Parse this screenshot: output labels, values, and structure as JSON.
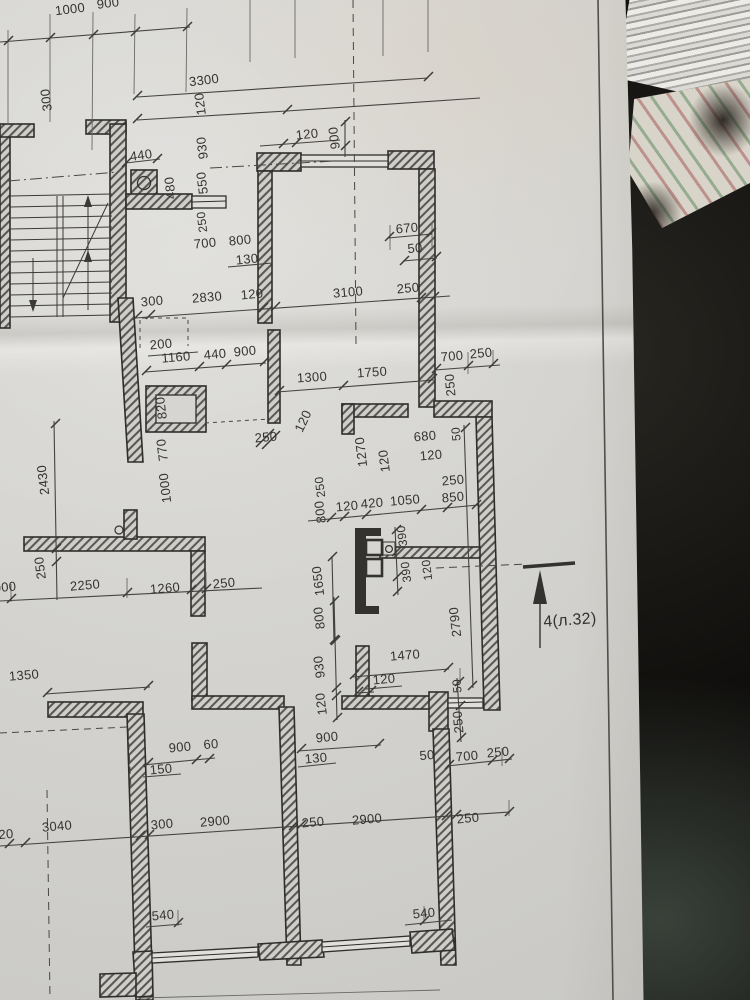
{
  "scene": {
    "description": "photo of an architectural floor plan on a dark table",
    "paper_color": "#d4d3cf",
    "table_color": "#171613",
    "line_color": "#35332f",
    "section_marker": "4(л.32)"
  },
  "plan": {
    "labels": [
      {
        "t": "1000",
        "x": 70,
        "y": 9,
        "r": -7
      },
      {
        "t": "900",
        "x": 108,
        "y": 3,
        "r": -7
      },
      {
        "t": "300",
        "x": 46,
        "y": 100,
        "r": -97
      },
      {
        "t": "3300",
        "x": 204,
        "y": 80,
        "r": -7
      },
      {
        "t": "120",
        "x": 200,
        "y": 104,
        "r": -97
      },
      {
        "t": "120",
        "x": 307,
        "y": 134,
        "r": -6
      },
      {
        "t": "900",
        "x": 334,
        "y": 138,
        "r": -97
      },
      {
        "t": "440",
        "x": 141,
        "y": 155,
        "r": -8
      },
      {
        "t": "930",
        "x": 202,
        "y": 148,
        "r": -97
      },
      {
        "t": "480",
        "x": 170,
        "y": 188,
        "r": -97
      },
      {
        "t": "550",
        "x": 202,
        "y": 183,
        "r": -97
      },
      {
        "t": "250",
        "x": 202,
        "y": 222,
        "r": -97,
        "s": 12
      },
      {
        "t": "700",
        "x": 205,
        "y": 243,
        "r": -6
      },
      {
        "t": "800",
        "x": 240,
        "y": 240,
        "r": -6
      },
      {
        "t": "130",
        "x": 247,
        "y": 259,
        "r": -6
      },
      {
        "t": "670",
        "x": 407,
        "y": 228,
        "r": -5
      },
      {
        "t": "50",
        "x": 415,
        "y": 248,
        "r": -5
      },
      {
        "t": "300",
        "x": 152,
        "y": 301,
        "r": -5
      },
      {
        "t": "2830",
        "x": 207,
        "y": 297,
        "r": -5
      },
      {
        "t": "120",
        "x": 252,
        "y": 294,
        "r": -5
      },
      {
        "t": "3100",
        "x": 348,
        "y": 292,
        "r": -5
      },
      {
        "t": "250",
        "x": 408,
        "y": 288,
        "r": -5
      },
      {
        "t": "200",
        "x": 161,
        "y": 344,
        "r": -5
      },
      {
        "t": "1160",
        "x": 176,
        "y": 357,
        "r": -5
      },
      {
        "t": "440",
        "x": 215,
        "y": 354,
        "r": -5
      },
      {
        "t": "900",
        "x": 245,
        "y": 351,
        "r": -5
      },
      {
        "t": "1300",
        "x": 312,
        "y": 377,
        "r": -4
      },
      {
        "t": "1750",
        "x": 372,
        "y": 372,
        "r": -4
      },
      {
        "t": "700",
        "x": 452,
        "y": 356,
        "r": -5
      },
      {
        "t": "250",
        "x": 481,
        "y": 353,
        "r": -5
      },
      {
        "t": "250",
        "x": 450,
        "y": 385,
        "r": -95
      },
      {
        "t": "820",
        "x": 161,
        "y": 408,
        "r": -97
      },
      {
        "t": "120",
        "x": 303,
        "y": 421,
        "r": -65
      },
      {
        "t": "250",
        "x": 266,
        "y": 437,
        "r": -5
      },
      {
        "t": "680",
        "x": 425,
        "y": 436,
        "r": -5
      },
      {
        "t": "120",
        "x": 431,
        "y": 455,
        "r": -5
      },
      {
        "t": "50",
        "x": 456,
        "y": 434,
        "r": -95,
        "s": 12
      },
      {
        "t": "1270",
        "x": 361,
        "y": 452,
        "r": -97
      },
      {
        "t": "120",
        "x": 384,
        "y": 461,
        "r": -97
      },
      {
        "t": "770",
        "x": 162,
        "y": 450,
        "r": -97
      },
      {
        "t": "1000",
        "x": 165,
        "y": 488,
        "r": -97
      },
      {
        "t": "2430",
        "x": 43,
        "y": 480,
        "r": -97
      },
      {
        "t": "250",
        "x": 40,
        "y": 568,
        "r": -97
      },
      {
        "t": "000",
        "x": 5,
        "y": 587,
        "r": -5
      },
      {
        "t": "2250",
        "x": 85,
        "y": 585,
        "r": -5
      },
      {
        "t": "1260",
        "x": 165,
        "y": 588,
        "r": -5
      },
      {
        "t": "250",
        "x": 224,
        "y": 583,
        "r": -5
      },
      {
        "t": "250",
        "x": 320,
        "y": 487,
        "r": -97,
        "s": 12
      },
      {
        "t": "800",
        "x": 320,
        "y": 512,
        "r": -97
      },
      {
        "t": "120",
        "x": 347,
        "y": 506,
        "r": -5
      },
      {
        "t": "420",
        "x": 372,
        "y": 503,
        "r": -5
      },
      {
        "t": "1050",
        "x": 405,
        "y": 500,
        "r": -5
      },
      {
        "t": "850",
        "x": 453,
        "y": 497,
        "r": -5
      },
      {
        "t": "250",
        "x": 453,
        "y": 480,
        "r": -5
      },
      {
        "t": "390",
        "x": 402,
        "y": 536,
        "r": -97,
        "s": 12
      },
      {
        "t": "390",
        "x": 406,
        "y": 572,
        "r": -97,
        "s": 12
      },
      {
        "t": "120",
        "x": 427,
        "y": 570,
        "r": -97,
        "s": 12
      },
      {
        "t": "1650",
        "x": 318,
        "y": 581,
        "r": -97
      },
      {
        "t": "2790",
        "x": 455,
        "y": 622,
        "r": -97
      },
      {
        "t": "800",
        "x": 319,
        "y": 618,
        "r": -97
      },
      {
        "t": "930",
        "x": 319,
        "y": 667,
        "r": -97
      },
      {
        "t": "120",
        "x": 321,
        "y": 704,
        "r": -97
      },
      {
        "t": "1470",
        "x": 405,
        "y": 655,
        "r": -5
      },
      {
        "t": "120",
        "x": 384,
        "y": 679,
        "r": -5
      },
      {
        "t": "1350",
        "x": 24,
        "y": 675,
        "r": -5
      },
      {
        "t": "900",
        "x": 180,
        "y": 747,
        "r": -5
      },
      {
        "t": "60",
        "x": 211,
        "y": 744,
        "r": -5
      },
      {
        "t": "150",
        "x": 161,
        "y": 769,
        "r": -5
      },
      {
        "t": "900",
        "x": 327,
        "y": 737,
        "r": -5
      },
      {
        "t": "130",
        "x": 316,
        "y": 758,
        "r": -5
      },
      {
        "t": "50",
        "x": 427,
        "y": 755,
        "r": -5
      },
      {
        "t": "700",
        "x": 467,
        "y": 756,
        "r": -5
      },
      {
        "t": "250",
        "x": 498,
        "y": 752,
        "r": -5
      },
      {
        "t": "50",
        "x": 457,
        "y": 686,
        "r": -95,
        "s": 12
      },
      {
        "t": "250",
        "x": 458,
        "y": 722,
        "r": -95
      },
      {
        "t": "20",
        "x": 6,
        "y": 834,
        "r": -5
      },
      {
        "t": "3040",
        "x": 57,
        "y": 826,
        "r": -5
      },
      {
        "t": "300",
        "x": 162,
        "y": 824,
        "r": -5
      },
      {
        "t": "2900",
        "x": 215,
        "y": 821,
        "r": -5
      },
      {
        "t": "250",
        "x": 313,
        "y": 822,
        "r": -5
      },
      {
        "t": "2900",
        "x": 367,
        "y": 819,
        "r": -5
      },
      {
        "t": "250",
        "x": 468,
        "y": 818,
        "r": -5
      },
      {
        "t": "540",
        "x": 163,
        "y": 915,
        "r": -5
      },
      {
        "t": "540",
        "x": 424,
        "y": 913,
        "r": -5
      },
      {
        "t": "4(л.32)",
        "x": 570,
        "y": 621,
        "r": -4,
        "s": 16
      }
    ]
  }
}
